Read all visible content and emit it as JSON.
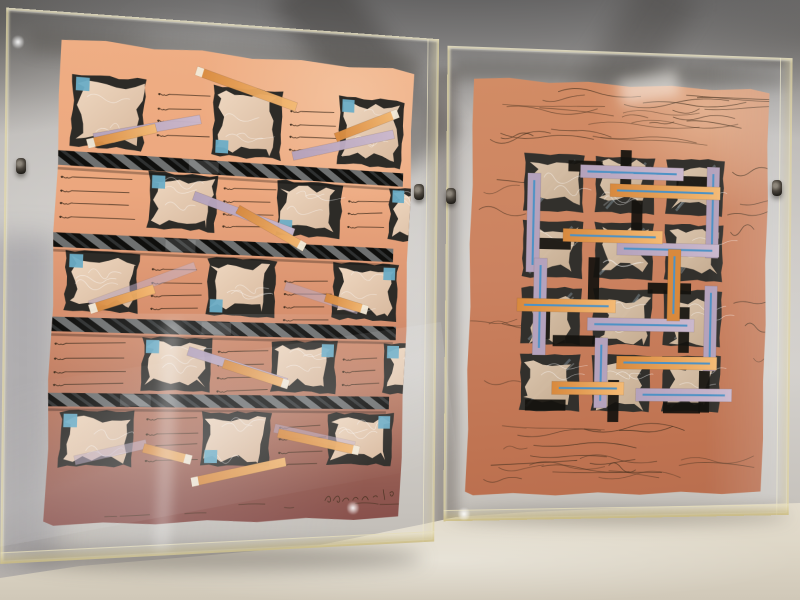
{
  "scene": {
    "type": "photograph",
    "description": "Two abstract mixed-media collage prints in clear acrylic box frames leaning against a draped fabric backdrop on a light table",
    "left_artwork_alt": "Salmon-to-mauve gradient print: staggered grid of torn tissue squares on charcoal patches with small blue squares, four black hatched bars, scattered diagonal orange and lavender strips, pen scribbles, signed lower right",
    "right_artwork_alt": "Terracotta print: central woven grid of torn tissue squares with black rectangles and lavender and orange strips with blue pinstripes, surrounded by loose pen scribbles"
  },
  "palette": {
    "fabric": "#c7c4c0",
    "fabric_light": "#e0dedb",
    "fabric_dark": "#55534f",
    "floor": "#ddd6c7",
    "floor_dark": "#c3bcae",
    "acrylic_edge": "#d8c992",
    "acrylic_face": "#e7ddb2",
    "left_paper_top": "#edac82",
    "left_paper_mid": "#d79070",
    "left_paper_bottom": "#874f4b",
    "right_paper": "#cb8260",
    "right_paper_dark": "#b96e4e",
    "cell_dark": "#2d2b27",
    "tissue_light": "#eed7c0",
    "tissue_shade": "#d8b99e",
    "right_cell_dark": "#32302c",
    "right_tissue": "#e0cab2",
    "right_tissue_shade": "#c9af93",
    "blue_square": "#6cadc6",
    "pinstripe_blue": "#4d92c5",
    "orange_strip": "#d8893d",
    "orange_strip_light": "#f4ba74",
    "strip_tip": "#f3ead8",
    "lavender_strip": "#b4a2bc",
    "lavender_strip_light": "#cab8cd",
    "bar_black": "#0f0f0d",
    "bar_hatch": "#cdd2d4",
    "ink": "#43301f",
    "streak_blue": "#95a9b4",
    "clip_dark": "#2b2722",
    "clip_light": "#9a948a"
  },
  "left_artwork": {
    "paper_size": {
      "w": 366,
      "h": 472
    },
    "grid": {
      "rows": [
        {
          "y": 34,
          "h": 72,
          "w": 72,
          "cells": [
            {
              "x": 13,
              "blue": "tl"
            },
            {
              "x": 152,
              "blue": "bl"
            },
            {
              "x": 283,
              "blue": "tl"
            }
          ]
        },
        {
          "y": 124,
          "h": 58,
          "w": 70,
          "cells": [
            {
              "x": 90,
              "blue": "tl"
            },
            {
              "x": 221,
              "blue": "bl"
            },
            {
              "x": 341,
              "blue": "tl"
            }
          ]
        },
        {
          "y": 205,
          "h": 60,
          "w": 72,
          "cells": [
            {
              "x": 13,
              "blue": "tl"
            },
            {
              "x": 152,
              "blue": "bl"
            },
            {
              "x": 283,
              "blue": "tr"
            }
          ]
        },
        {
          "y": 286,
          "h": 55,
          "w": 70,
          "cells": [
            {
              "x": 90,
              "blue": "tl"
            },
            {
              "x": 221,
              "blue": "tr"
            },
            {
              "x": 341,
              "blue": "tl"
            }
          ]
        },
        {
          "y": 359,
          "h": 56,
          "w": 72,
          "cells": [
            {
              "x": 13,
              "blue": "tl"
            },
            {
              "x": 152,
              "blue": "bl"
            },
            {
              "x": 283,
              "blue": "tr"
            }
          ]
        }
      ],
      "blue_square_size": 13
    },
    "bars": [
      [
        -4,
        356,
        110,
        14
      ],
      [
        -4,
        348,
        189,
        14
      ],
      [
        -4,
        354,
        270,
        14
      ],
      [
        -4,
        349,
        343,
        13
      ]
    ],
    "strips": [
      [
        "orange",
        134,
        22,
        238,
        50,
        "start",
        0
      ],
      [
        "lavender",
        36,
        96,
        140,
        70,
        "",
        0
      ],
      [
        "orange",
        30,
        102,
        96,
        82,
        "start",
        0
      ],
      [
        "lavender",
        236,
        100,
        344,
        70,
        "",
        0
      ],
      [
        "orange",
        281,
        78,
        348,
        48,
        "end",
        0
      ],
      [
        "lavender",
        136,
        146,
        240,
        178,
        "",
        0
      ],
      [
        "orange",
        181,
        157,
        252,
        192,
        "end",
        0
      ],
      [
        "lavender",
        38,
        258,
        140,
        216,
        "",
        1
      ],
      [
        "orange",
        38,
        262,
        100,
        240,
        "start",
        0
      ],
      [
        "lavender",
        233,
        232,
        312,
        254,
        "",
        1
      ],
      [
        "orange",
        276,
        242,
        322,
        254,
        "end",
        0
      ],
      [
        "lavender",
        136,
        300,
        238,
        330,
        "",
        0
      ],
      [
        "orange",
        172,
        312,
        240,
        332,
        "end",
        0
      ],
      [
        "lavender",
        29,
        408,
        98,
        392,
        "",
        1
      ],
      [
        "orange",
        95,
        396,
        143,
        408,
        "end",
        0
      ],
      [
        "orange",
        144,
        430,
        240,
        410,
        "start",
        0
      ],
      [
        "lavender",
        227,
        376,
        313,
        394,
        "",
        1
      ],
      [
        "orange",
        231,
        381,
        318,
        399,
        "end",
        0
      ]
    ],
    "scribble_groups": [
      [
        97,
        48,
        4,
        48
      ],
      [
        232,
        54,
        4,
        46
      ],
      [
        6,
        134,
        4,
        70
      ],
      [
        166,
        136,
        4,
        50
      ],
      [
        297,
        142,
        3,
        40
      ],
      [
        97,
        220,
        4,
        48
      ],
      [
        232,
        226,
        4,
        46
      ],
      [
        6,
        296,
        4,
        70
      ],
      [
        166,
        300,
        4,
        50
      ],
      [
        297,
        304,
        3,
        40
      ],
      [
        97,
        368,
        4,
        48
      ],
      [
        232,
        374,
        4,
        46
      ]
    ],
    "scribble_regions": [
      [
        15,
        452,
        330,
        14,
        7
      ]
    ],
    "signature": {
      "present": true,
      "x": 283,
      "y": 444,
      "w": 58
    }
  },
  "right_artwork": {
    "paper_size": {
      "w": 300,
      "h": 414
    },
    "motif": {
      "x": 52,
      "y": 74,
      "cols": 3,
      "rows": 4,
      "cell_w": 60,
      "cell_h": 58,
      "gap_x": 11,
      "gap_y": 8
    },
    "overlays": {
      "black": [
        [
          96,
          80,
          34,
          11
        ],
        [
          148,
          68,
          11,
          42
        ],
        [
          205,
          92,
          42,
          11
        ],
        [
          160,
          118,
          11,
          36
        ],
        [
          60,
          158,
          40,
          11
        ],
        [
          118,
          176,
          11,
          44
        ],
        [
          178,
          200,
          44,
          11
        ],
        [
          70,
          222,
          11,
          36
        ],
        [
          210,
          224,
          11,
          46
        ],
        [
          84,
          254,
          42,
          11
        ],
        [
          140,
          298,
          11,
          42
        ],
        [
          58,
          318,
          40,
          11
        ],
        [
          232,
          288,
          11,
          42
        ],
        [
          196,
          320,
          38,
          11
        ]
      ],
      "lavender": [
        [
          108,
          84,
          104,
          13
        ],
        [
          56,
          94,
          13,
          98
        ],
        [
          236,
          82,
          13,
          92
        ],
        [
          146,
          160,
          104,
          13
        ],
        [
          64,
          178,
          13,
          96
        ],
        [
          118,
          236,
          108,
          13
        ],
        [
          236,
          202,
          13,
          86
        ],
        [
          168,
          306,
          98,
          13
        ],
        [
          126,
          256,
          13,
          70
        ]
      ],
      "orange": [
        [
          138,
          102,
          112,
          13
        ],
        [
          92,
          148,
          100,
          13
        ],
        [
          48,
          218,
          98,
          13
        ],
        [
          198,
          166,
          13,
          72
        ],
        [
          148,
          274,
          102,
          13
        ],
        [
          84,
          300,
          72,
          13
        ]
      ]
    },
    "scribble_regions": [
      [
        12,
        8,
        276,
        58,
        24
      ],
      [
        2,
        84,
        46,
        224,
        7
      ],
      [
        256,
        84,
        42,
        224,
        7
      ],
      [
        8,
        336,
        284,
        72,
        20
      ]
    ]
  },
  "clips": [
    [
      16,
      158
    ],
    [
      414,
      184
    ],
    [
      446,
      188
    ],
    [
      772,
      180
    ]
  ],
  "sparkles": [
    [
      347,
      500
    ],
    [
      458,
      506
    ],
    [
      12,
      34
    ]
  ]
}
